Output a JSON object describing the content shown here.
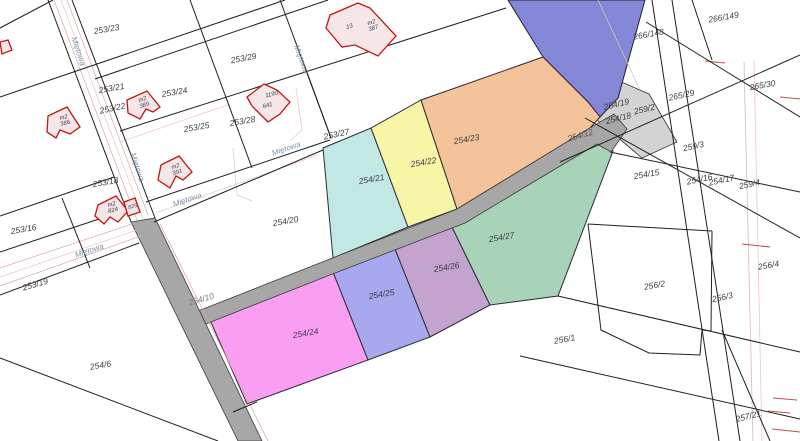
{
  "map": {
    "type": "cadastral-parcel-map",
    "colors": {
      "background": "#ffffff",
      "boundary": "#1f1f1f",
      "road_gray": "#a7a7a7",
      "corridor_gray": "#d3d3d3",
      "highlight_band": "#8487d8",
      "building_stroke": "#c41414",
      "building_fill": "#f5e7e7",
      "utility_pink": "#dfa3a3",
      "utility_pink_light": "#ecc5c5",
      "utility_tan": "#d8c6ae",
      "tick_red": "#c05050",
      "parcel_label": "#3d3d47",
      "road_label": "#787878",
      "street_label": "#7e93ab",
      "building_label": "#3f3f4a"
    },
    "highlighted_parcels": [
      {
        "id": "254/21",
        "color": "#c2e8e4"
      },
      {
        "id": "254/22",
        "color": "#f7f5a6"
      },
      {
        "id": "254/23",
        "color": "#f4c39a"
      },
      {
        "id": "254/24",
        "color": "#f99ef2"
      },
      {
        "id": "254/25",
        "color": "#a8a8ee"
      },
      {
        "id": "254/26",
        "color": "#c4a3cf"
      },
      {
        "id": "254/27",
        "color": "#a9d3b8"
      },
      {
        "id": "road-band",
        "color": "#8487d8"
      },
      {
        "id": "road-254-10",
        "color": "#a7a7a7"
      },
      {
        "id": "road-254-13",
        "color": "#a7a7a7"
      },
      {
        "id": "corridor-259",
        "color": "#d3d3d3"
      }
    ],
    "parcel_labels": [
      {
        "text": "253/21",
        "x": 112,
        "y": 91,
        "rot": -10
      },
      {
        "text": "253/23",
        "x": 107,
        "y": 32,
        "rot": -10
      },
      {
        "text": "253/29",
        "x": 244,
        "y": 61,
        "rot": -10
      },
      {
        "text": "253/24",
        "x": 175,
        "y": 95,
        "rot": -10
      },
      {
        "text": "253/22",
        "x": 113,
        "y": 111,
        "rot": -12
      },
      {
        "text": "253/25",
        "x": 197,
        "y": 130,
        "rot": -10
      },
      {
        "text": "253/28",
        "x": 243,
        "y": 124,
        "rot": -10
      },
      {
        "text": "253/27",
        "x": 337,
        "y": 137,
        "rot": -12
      },
      {
        "text": "253/18",
        "x": 106,
        "y": 185,
        "rot": -10
      },
      {
        "text": "253/16",
        "x": 24,
        "y": 232,
        "rot": -10
      },
      {
        "text": "253/19",
        "x": 36,
        "y": 287,
        "rot": -16
      },
      {
        "text": "254/20",
        "x": 286,
        "y": 224,
        "rot": -10
      },
      {
        "text": "254/6",
        "x": 101,
        "y": 368,
        "rot": -10
      },
      {
        "text": "254/10",
        "x": 202,
        "y": 302,
        "rot": -16,
        "color": "#787878"
      },
      {
        "text": "254/21",
        "x": 372,
        "y": 182,
        "rot": -10
      },
      {
        "text": "254/22",
        "x": 424,
        "y": 165,
        "rot": -10
      },
      {
        "text": "254/23",
        "x": 467,
        "y": 142,
        "rot": -10
      },
      {
        "text": "254/24",
        "x": 306,
        "y": 336,
        "rot": -10
      },
      {
        "text": "254/25",
        "x": 382,
        "y": 297,
        "rot": -10
      },
      {
        "text": "254/26",
        "x": 447,
        "y": 270,
        "rot": -10
      },
      {
        "text": "254/27",
        "x": 502,
        "y": 240,
        "rot": -10
      },
      {
        "text": "254/12",
        "x": 581,
        "y": 138,
        "rot": -16,
        "color": "#55555e"
      },
      {
        "text": "254/19",
        "x": 617,
        "y": 107,
        "rot": -14
      },
      {
        "text": "254/18",
        "x": 619,
        "y": 121,
        "rot": -14
      },
      {
        "text": "259/2",
        "x": 645,
        "y": 112,
        "rot": -14
      },
      {
        "text": "265/29",
        "x": 682,
        "y": 98,
        "rot": -12
      },
      {
        "text": "266/148",
        "x": 649,
        "y": 37,
        "rot": -10
      },
      {
        "text": "266/149",
        "x": 724,
        "y": 20,
        "rot": -10
      },
      {
        "text": "265/30",
        "x": 763,
        "y": 88,
        "rot": -10
      },
      {
        "text": "259/3",
        "x": 694,
        "y": 149,
        "rot": -12
      },
      {
        "text": "254/15",
        "x": 647,
        "y": 177,
        "rot": -10
      },
      {
        "text": "254/16",
        "x": 700,
        "y": 182,
        "rot": -12
      },
      {
        "text": "254/17",
        "x": 722,
        "y": 183,
        "rot": -12
      },
      {
        "text": "259/4",
        "x": 750,
        "y": 187,
        "rot": -12
      },
      {
        "text": "256/2",
        "x": 655,
        "y": 288,
        "rot": -10
      },
      {
        "text": "256/3",
        "x": 723,
        "y": 300,
        "rot": -12
      },
      {
        "text": "256/4",
        "x": 769,
        "y": 268,
        "rot": -10
      },
      {
        "text": "256/1",
        "x": 565,
        "y": 342,
        "rot": -10
      },
      {
        "text": "257/21",
        "x": 749,
        "y": 419,
        "rot": -14
      }
    ],
    "street_labels": [
      {
        "text": "Miętowa",
        "x": 76,
        "y": 52,
        "rot": 72
      },
      {
        "text": "Miętowa",
        "x": 299,
        "y": 60,
        "rot": 70
      },
      {
        "text": "Miętowa",
        "x": 135,
        "y": 168,
        "rot": 72
      },
      {
        "text": "Miętowa",
        "x": 188,
        "y": 202,
        "rot": -19
      },
      {
        "text": "Miętowa",
        "x": 287,
        "y": 151,
        "rot": -19
      },
      {
        "text": "Miętowa",
        "x": 90,
        "y": 253,
        "rot": -18
      }
    ],
    "building_labels": [
      {
        "lines": [
          "m2",
          "387"
        ],
        "x": 372,
        "y": 24,
        "rot": -18,
        "size": 6
      },
      {
        "lines": [
          "13"
        ],
        "x": 350,
        "y": 28,
        "rot": -18,
        "size": 6
      },
      {
        "lines": [
          "m2",
          "386"
        ],
        "x": 64,
        "y": 119,
        "rot": -14,
        "size": 6
      },
      {
        "lines": [
          "m2",
          "389"
        ],
        "x": 143,
        "y": 101,
        "rot": -18,
        "size": 6
      },
      {
        "lines": [
          "m2",
          "391"
        ],
        "x": 176,
        "y": 168,
        "rot": -18,
        "size": 6
      },
      {
        "lines": [
          "m2",
          "824"
        ],
        "x": 112,
        "y": 206,
        "rot": -14,
        "size": 6
      },
      {
        "lines": [
          "825"
        ],
        "x": 133,
        "y": 208,
        "rot": -14,
        "size": 5.5
      },
      {
        "lines": [
          "1190"
        ],
        "x": 272,
        "y": 96,
        "rot": -14,
        "size": 6
      },
      {
        "lines": [
          "641"
        ],
        "x": 268,
        "y": 107,
        "rot": -14,
        "size": 6
      }
    ]
  }
}
